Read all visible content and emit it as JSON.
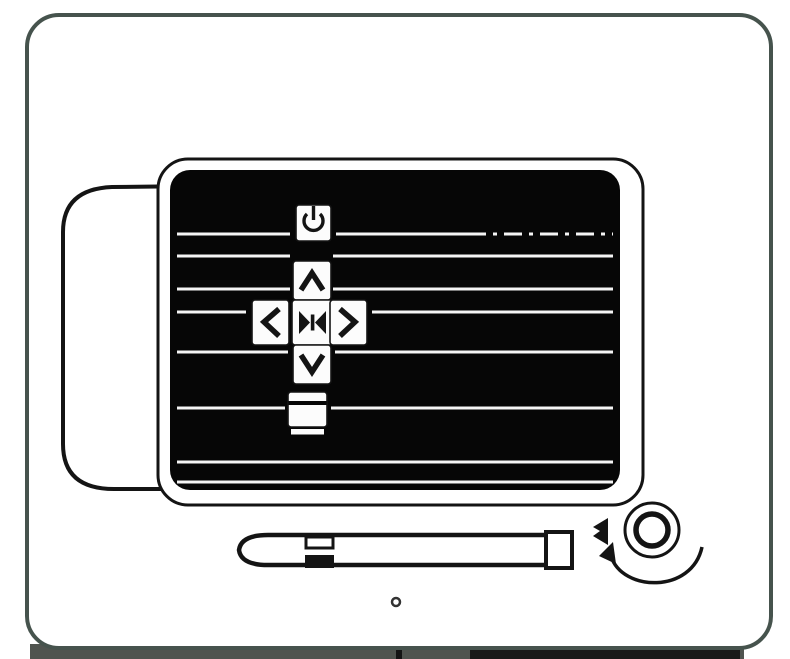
{
  "colors": {
    "background": "#ffffff",
    "frame_border": "#46534d",
    "ink": "#141414",
    "panel_fill": "#060606",
    "grille": "#f4f4f4",
    "button_fill": "#fcfcfc",
    "band_gray": "#50544f",
    "band_dark": "#191919"
  },
  "control_panel": {
    "grille_line_count": 8,
    "buttons": [
      {
        "id": "power",
        "label": "Power",
        "icon": "power-icon"
      },
      {
        "id": "up",
        "label": "Up",
        "icon": "chevron-up-icon"
      },
      {
        "id": "left",
        "label": "Left",
        "icon": "chevron-left-icon"
      },
      {
        "id": "enter",
        "label": "Enter",
        "icon": "enter-icon"
      },
      {
        "id": "right",
        "label": "Right",
        "icon": "chevron-right-icon"
      },
      {
        "id": "down",
        "label": "Down",
        "icon": "chevron-down-icon"
      },
      {
        "id": "menu",
        "label": "Menu",
        "icon": "menu-icon"
      }
    ]
  },
  "accessories": {
    "stylus": {
      "label": "Stylus pen"
    },
    "knob": {
      "label": "Rotary knob",
      "rotation_hint": "curved-arrow"
    },
    "indicator": {
      "label": "Knob indicator mark"
    },
    "pinhole": {
      "label": "Pinhole"
    }
  }
}
